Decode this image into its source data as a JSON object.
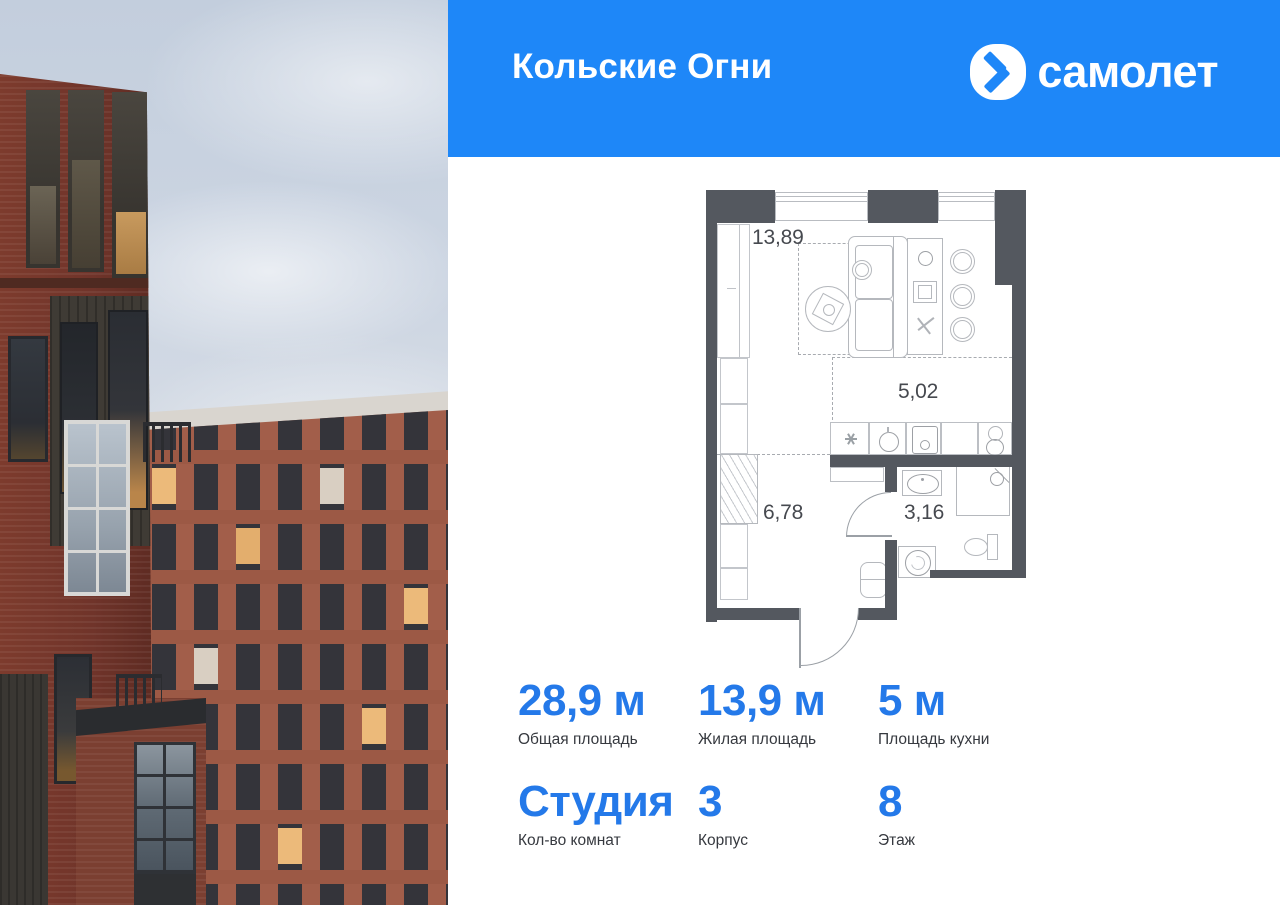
{
  "header": {
    "project_title": "Кольские Огни",
    "brand_name": "самолет",
    "brand_color": "#1e87f8"
  },
  "floor_plan": {
    "rooms": [
      {
        "id": "living-room",
        "area": "13,89"
      },
      {
        "id": "kitchen",
        "area": "5,02"
      },
      {
        "id": "hallway",
        "area": "6,78"
      },
      {
        "id": "bathroom",
        "area": "3,16"
      }
    ],
    "wall_color": "#54585f"
  },
  "stats": {
    "accent_color": "#2479e9",
    "items": [
      {
        "value": "28,9 м",
        "label": "Общая площадь"
      },
      {
        "value": "13,9 м",
        "label": "Жилая площадь"
      },
      {
        "value": "5 м",
        "label": "Площадь кухни"
      },
      {
        "value": "Студия",
        "label": "Кол-во комнат"
      },
      {
        "value": "3",
        "label": "Корпус"
      },
      {
        "value": "8",
        "label": "Этаж"
      }
    ]
  }
}
